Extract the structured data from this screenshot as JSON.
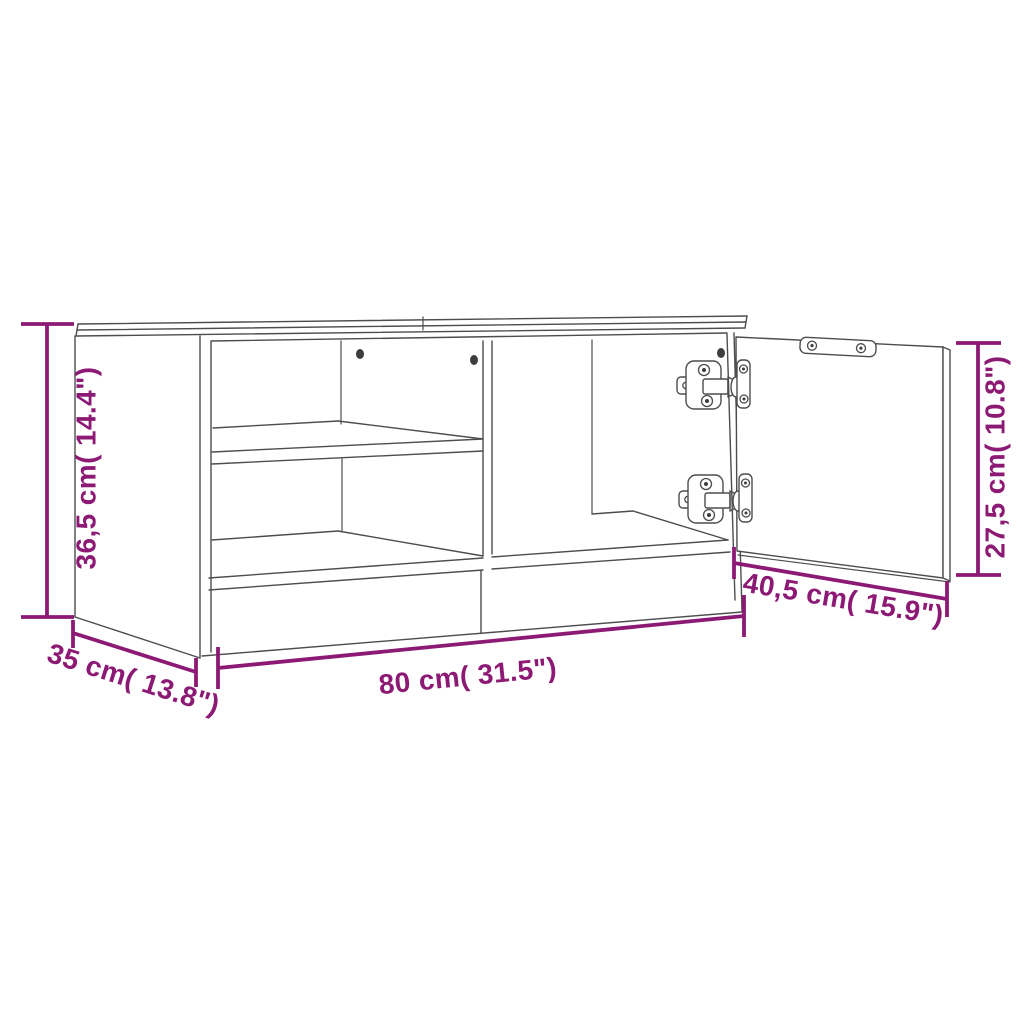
{
  "figure": {
    "type": "furniture-dimension-diagram",
    "subject": "TV cabinet line drawing with open right door, interior shelf, divider and concealed hinges",
    "colors": {
      "accent": "#8C1A74",
      "line": "#4d4d4d"
    },
    "dimensions": {
      "height": "36,5 cm( 14.4\")",
      "width": "80 cm( 31.5\")",
      "depth": "35 cm( 13.8\")",
      "door_width": "40,5 cm( 15.9\")",
      "door_height": "27,5 cm( 10.8\")"
    }
  }
}
